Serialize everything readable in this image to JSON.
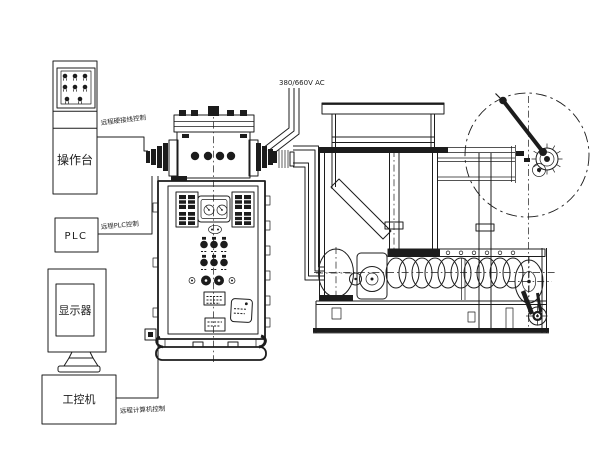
{
  "colors": {
    "ink": "#1c1c1c",
    "paper": "#ffffff"
  },
  "stations": {
    "console": {
      "label": "操作台"
    },
    "plc": {
      "label": "PLC"
    },
    "monitor": {
      "label": "显示器"
    },
    "computer": {
      "label": "工控机"
    }
  },
  "links": {
    "hardwire": "远程硬接线控制",
    "plc": "远程PLC控制",
    "computer": "远程计算机控制"
  },
  "power": {
    "label": "380/660V AC"
  }
}
